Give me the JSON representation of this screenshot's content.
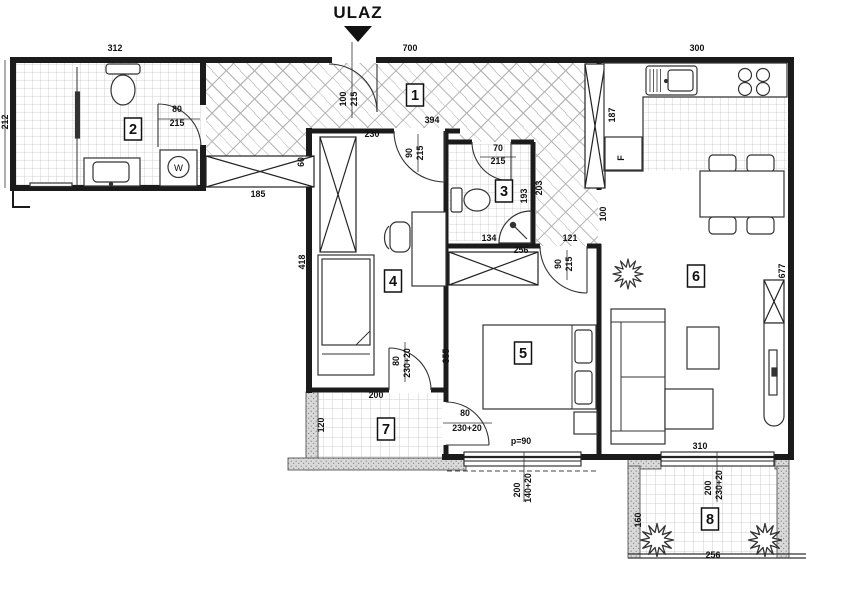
{
  "title": {
    "entrance": "ULAZ"
  },
  "fixtures": {
    "washer": "W",
    "fridge": "F"
  },
  "rooms": [
    {
      "n": "1",
      "x": 415,
      "y": 95
    },
    {
      "n": "2",
      "x": 133,
      "y": 129
    },
    {
      "n": "3",
      "x": 504,
      "y": 191
    },
    {
      "n": "4",
      "x": 393,
      "y": 281
    },
    {
      "n": "5",
      "x": 523,
      "y": 353
    },
    {
      "n": "6",
      "x": 696,
      "y": 276
    },
    {
      "n": "7",
      "x": 386,
      "y": 429
    },
    {
      "n": "8",
      "x": 710,
      "y": 519
    }
  ],
  "dims": [
    {
      "t": "312",
      "x": 115,
      "y": 51
    },
    {
      "t": "700",
      "x": 410,
      "y": 51
    },
    {
      "t": "300",
      "x": 697,
      "y": 51
    },
    {
      "t": "212",
      "x": 8,
      "y": 122,
      "r": -90
    },
    {
      "t": "80",
      "x": 177,
      "y": 112
    },
    {
      "t": "215",
      "x": 177,
      "y": 126
    },
    {
      "t": "185",
      "x": 258,
      "y": 197
    },
    {
      "t": "60",
      "x": 304,
      "y": 162,
      "r": -90
    },
    {
      "t": "100",
      "x": 346,
      "y": 99,
      "r": -90
    },
    {
      "t": "215",
      "x": 357,
      "y": 99,
      "r": -90
    },
    {
      "t": "394",
      "x": 432,
      "y": 123
    },
    {
      "t": "230",
      "x": 372,
      "y": 137
    },
    {
      "t": "90",
      "x": 412,
      "y": 153,
      "r": -90
    },
    {
      "t": "215",
      "x": 423,
      "y": 153,
      "r": -90
    },
    {
      "t": "70",
      "x": 498,
      "y": 151
    },
    {
      "t": "215",
      "x": 498,
      "y": 164
    },
    {
      "t": "193",
      "x": 527,
      "y": 196,
      "r": -90
    },
    {
      "t": "203",
      "x": 542,
      "y": 188,
      "r": -90
    },
    {
      "t": "134",
      "x": 489,
      "y": 241
    },
    {
      "t": "121",
      "x": 570,
      "y": 241
    },
    {
      "t": "187",
      "x": 615,
      "y": 115,
      "r": -90
    },
    {
      "t": "100",
      "x": 606,
      "y": 214,
      "r": -90
    },
    {
      "t": "256",
      "x": 521,
      "y": 253
    },
    {
      "t": "90",
      "x": 561,
      "y": 264,
      "r": -90
    },
    {
      "t": "215",
      "x": 572,
      "y": 264,
      "r": -90
    },
    {
      "t": "355",
      "x": 449,
      "y": 356,
      "r": -90
    },
    {
      "t": "418",
      "x": 305,
      "y": 262,
      "r": -90
    },
    {
      "t": "80",
      "x": 399,
      "y": 361,
      "r": -90
    },
    {
      "t": "230+20",
      "x": 410,
      "y": 363,
      "r": -90
    },
    {
      "t": "200",
      "x": 376,
      "y": 398
    },
    {
      "t": "120",
      "x": 324,
      "y": 425,
      "r": -90
    },
    {
      "t": "80",
      "x": 465,
      "y": 416
    },
    {
      "t": "230+20",
      "x": 467,
      "y": 431
    },
    {
      "t": "p=90",
      "x": 521,
      "y": 444
    },
    {
      "t": "200",
      "x": 520,
      "y": 490,
      "r": -90
    },
    {
      "t": "140+20",
      "x": 531,
      "y": 488,
      "r": -90
    },
    {
      "t": "310",
      "x": 700,
      "y": 449
    },
    {
      "t": "200",
      "x": 711,
      "y": 488,
      "r": -90
    },
    {
      "t": "230+20",
      "x": 722,
      "y": 485,
      "r": -90
    },
    {
      "t": "677",
      "x": 785,
      "y": 271,
      "r": -90
    },
    {
      "t": "160",
      "x": 641,
      "y": 520,
      "r": -90
    },
    {
      "t": "256",
      "x": 713,
      "y": 558
    }
  ]
}
